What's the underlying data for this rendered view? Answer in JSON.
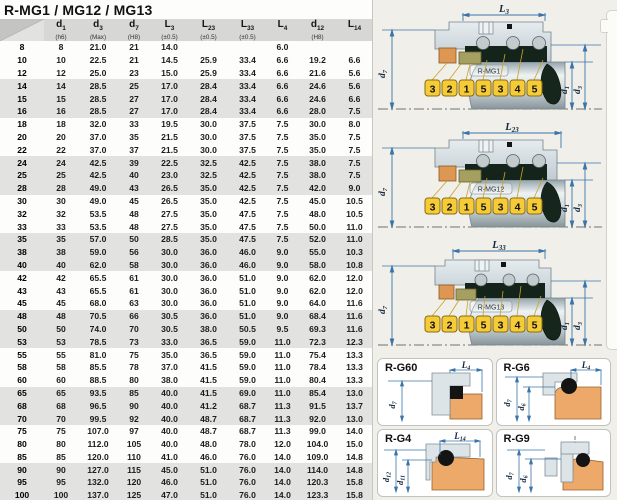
{
  "title": "R-MG1 / MG12 / MG13",
  "table": {
    "headers": [
      {
        "base": "d",
        "sub": "1",
        "tol": "(h6)"
      },
      {
        "base": "d",
        "sub": "3",
        "tol": "(Max)"
      },
      {
        "base": "d",
        "sub": "7",
        "tol": "(H8)"
      },
      {
        "base": "L",
        "sub": "3",
        "tol": "(±0.5)"
      },
      {
        "base": "L",
        "sub": "23",
        "tol": "(±0.5)"
      },
      {
        "base": "L",
        "sub": "33",
        "tol": "(±0.5)"
      },
      {
        "base": "L",
        "sub": "4",
        "tol": ""
      },
      {
        "base": "d",
        "sub": "12",
        "tol": "(H8)"
      },
      {
        "base": "L",
        "sub": "14",
        "tol": ""
      }
    ],
    "rows": [
      [
        "8",
        "8",
        "21.0",
        "21",
        "14.0",
        "",
        "",
        "6.0",
        "",
        ""
      ],
      [
        "10",
        "10",
        "22.5",
        "21",
        "14.5",
        "25.9",
        "33.4",
        "6.6",
        "19.2",
        "6.6"
      ],
      [
        "12",
        "12",
        "25.0",
        "23",
        "15.0",
        "25.9",
        "33.4",
        "6.6",
        "21.6",
        "5.6"
      ],
      [
        "14",
        "14",
        "28.5",
        "25",
        "17.0",
        "28.4",
        "33.4",
        "6.6",
        "24.6",
        "5.6"
      ],
      [
        "15",
        "15",
        "28.5",
        "27",
        "17.0",
        "28.4",
        "33.4",
        "6.6",
        "24.6",
        "6.6"
      ],
      [
        "16",
        "16",
        "28.5",
        "27",
        "17.0",
        "28.4",
        "33.4",
        "6.6",
        "28.0",
        "7.5"
      ],
      [
        "18",
        "18",
        "32.0",
        "33",
        "19.5",
        "30.0",
        "37.5",
        "7.5",
        "30.0",
        "8.0"
      ],
      [
        "20",
        "20",
        "37.0",
        "35",
        "21.5",
        "30.0",
        "37.5",
        "7.5",
        "35.0",
        "7.5"
      ],
      [
        "22",
        "22",
        "37.0",
        "37",
        "21.5",
        "30.0",
        "37.5",
        "7.5",
        "35.0",
        "7.5"
      ],
      [
        "24",
        "24",
        "42.5",
        "39",
        "22.5",
        "32.5",
        "42.5",
        "7.5",
        "38.0",
        "7.5"
      ],
      [
        "25",
        "25",
        "42.5",
        "40",
        "23.0",
        "32.5",
        "42.5",
        "7.5",
        "38.0",
        "7.5"
      ],
      [
        "28",
        "28",
        "49.0",
        "43",
        "26.5",
        "35.0",
        "42.5",
        "7.5",
        "42.0",
        "9.0"
      ],
      [
        "30",
        "30",
        "49.0",
        "45",
        "26.5",
        "35.0",
        "42.5",
        "7.5",
        "45.0",
        "10.5"
      ],
      [
        "32",
        "32",
        "53.5",
        "48",
        "27.5",
        "35.0",
        "47.5",
        "7.5",
        "48.0",
        "10.5"
      ],
      [
        "33",
        "33",
        "53.5",
        "48",
        "27.5",
        "35.0",
        "47.5",
        "7.5",
        "50.0",
        "11.0"
      ],
      [
        "35",
        "35",
        "57.0",
        "50",
        "28.5",
        "35.0",
        "47.5",
        "7.5",
        "52.0",
        "11.0"
      ],
      [
        "38",
        "38",
        "59.0",
        "56",
        "30.0",
        "36.0",
        "46.0",
        "9.0",
        "55.0",
        "10.3"
      ],
      [
        "40",
        "40",
        "62.0",
        "58",
        "30.0",
        "36.0",
        "46.0",
        "9.0",
        "58.0",
        "10.8"
      ],
      [
        "42",
        "42",
        "65.5",
        "61",
        "30.0",
        "36.0",
        "51.0",
        "9.0",
        "62.0",
        "12.0"
      ],
      [
        "43",
        "43",
        "65.5",
        "61",
        "30.0",
        "36.0",
        "51.0",
        "9.0",
        "62.0",
        "12.0"
      ],
      [
        "45",
        "45",
        "68.0",
        "63",
        "30.0",
        "36.0",
        "51.0",
        "9.0",
        "64.0",
        "11.6"
      ],
      [
        "48",
        "48",
        "70.5",
        "66",
        "30.5",
        "36.0",
        "51.0",
        "9.0",
        "68.4",
        "11.6"
      ],
      [
        "50",
        "50",
        "74.0",
        "70",
        "30.5",
        "38.0",
        "50.5",
        "9.5",
        "69.3",
        "11.6"
      ],
      [
        "53",
        "53",
        "78.5",
        "73",
        "33.0",
        "36.5",
        "59.0",
        "11.0",
        "72.3",
        "12.3"
      ],
      [
        "55",
        "55",
        "81.0",
        "75",
        "35.0",
        "36.5",
        "59.0",
        "11.0",
        "75.4",
        "13.3"
      ],
      [
        "58",
        "58",
        "85.5",
        "78",
        "37.0",
        "41.5",
        "59.0",
        "11.0",
        "78.4",
        "13.3"
      ],
      [
        "60",
        "60",
        "88.5",
        "80",
        "38.0",
        "41.5",
        "59.0",
        "11.0",
        "80.4",
        "13.3"
      ],
      [
        "65",
        "65",
        "93.5",
        "85",
        "40.0",
        "41.5",
        "69.0",
        "11.0",
        "85.4",
        "13.0"
      ],
      [
        "68",
        "68",
        "96.5",
        "90",
        "40.0",
        "41.2",
        "68.7",
        "11.3",
        "91.5",
        "13.7"
      ],
      [
        "70",
        "70",
        "99.5",
        "92",
        "40.0",
        "48.7",
        "68.7",
        "11.3",
        "92.0",
        "13.0"
      ],
      [
        "75",
        "75",
        "107.0",
        "97",
        "40.0",
        "48.7",
        "68.7",
        "11.3",
        "99.0",
        "14.0"
      ],
      [
        "80",
        "80",
        "112.0",
        "105",
        "40.0",
        "48.0",
        "78.0",
        "12.0",
        "104.0",
        "15.0"
      ],
      [
        "85",
        "85",
        "120.0",
        "110",
        "41.0",
        "46.0",
        "76.0",
        "14.0",
        "109.0",
        "14.8"
      ],
      [
        "90",
        "90",
        "127.0",
        "115",
        "45.0",
        "51.0",
        "76.0",
        "14.0",
        "114.0",
        "14.8"
      ],
      [
        "95",
        "95",
        "132.0",
        "120",
        "46.0",
        "51.0",
        "76.0",
        "14.0",
        "120.3",
        "15.8"
      ],
      [
        "100",
        "100",
        "137.0",
        "125",
        "47.0",
        "51.0",
        "76.0",
        "14.0",
        "123.3",
        "15.8"
      ]
    ]
  },
  "diagrams": [
    {
      "name": "R-MG1",
      "top_dim": {
        "base": "L",
        "sub": "3"
      },
      "left_dim": {
        "base": "d",
        "sub": "7"
      },
      "right_dim1": {
        "base": "d",
        "sub": "1"
      },
      "right_dim2": {
        "base": "d",
        "sub": "3"
      },
      "callouts": [
        "3",
        "2",
        "1",
        "5",
        "3",
        "4",
        "5"
      ]
    },
    {
      "name": "R-MG12",
      "top_dim": {
        "base": "L",
        "sub": "23"
      },
      "left_dim": {
        "base": "d",
        "sub": "7"
      },
      "right_dim1": {
        "base": "d",
        "sub": "1"
      },
      "right_dim2": {
        "base": "d",
        "sub": "3"
      },
      "callouts": [
        "3",
        "2",
        "1",
        "5",
        "3",
        "4",
        "5"
      ]
    },
    {
      "name": "R-MG13",
      "top_dim": {
        "base": "L",
        "sub": "33"
      },
      "left_dim": {
        "base": "d",
        "sub": "7"
      },
      "right_dim1": {
        "base": "d",
        "sub": "1"
      },
      "right_dim2": {
        "base": "d",
        "sub": "3"
      },
      "callouts": [
        "3",
        "2",
        "1",
        "5",
        "3",
        "4",
        "5"
      ]
    }
  ],
  "panels": [
    {
      "name": "R-G60",
      "top_dim": {
        "base": "L",
        "sub": "4"
      },
      "dim_a": {
        "base": "d",
        "sub": "7"
      },
      "dim_b": null
    },
    {
      "name": "R-G6",
      "top_dim": {
        "base": "L",
        "sub": "4"
      },
      "dim_a": {
        "base": "d",
        "sub": "7"
      },
      "dim_b": {
        "base": "d",
        "sub": "6"
      }
    },
    {
      "name": "R-G4",
      "top_dim": {
        "base": "L",
        "sub": "14"
      },
      "dim_a": {
        "base": "d",
        "sub": "12"
      },
      "dim_b": {
        "base": "d",
        "sub": "11"
      }
    },
    {
      "name": "R-G9",
      "top_dim": null,
      "dim_a": {
        "base": "d",
        "sub": "7"
      },
      "dim_b": {
        "base": "d",
        "sub": "6"
      }
    }
  ],
  "colors": {
    "header_bg": "#d7d7d6",
    "row_shade": "#e2e2e0",
    "dim_line": "#3a74a8",
    "metal": "#dbe3e8",
    "bellows": "#15241b",
    "seat_orange": "#dd9752",
    "face_olive": "#a5a061",
    "chip_yellow": "#f6cb38",
    "chip_border": "#8a6c14",
    "panel_orange": "#eca96a"
  }
}
